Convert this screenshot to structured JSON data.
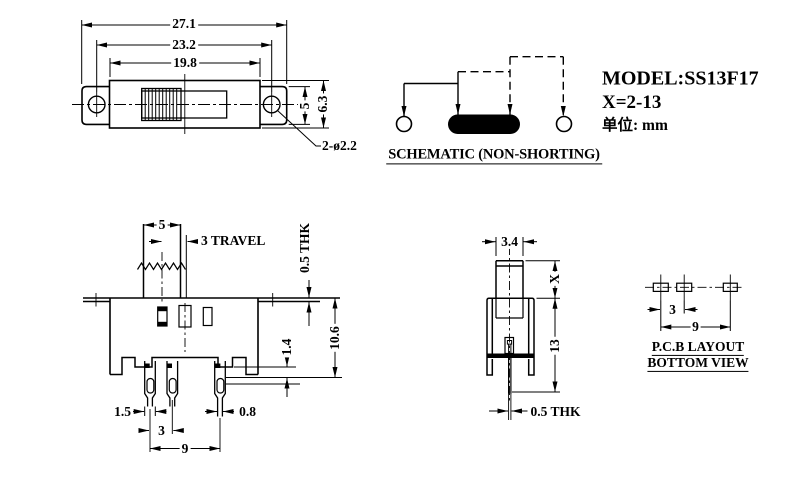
{
  "colors": {
    "ink": "#000000",
    "paper": "#ffffff"
  },
  "title_block": {
    "model": "MODEL:SS13F17",
    "x_range": "X=2-13",
    "unit_label": "单位: mm"
  },
  "schematic": {
    "caption": "SCHEMATIC (NON-SHORTING)"
  },
  "top_view": {
    "dim_overall": "27.1",
    "dim_hole_spacing": "23.2",
    "dim_body_length": "19.8",
    "dim_ear_height": "5",
    "dim_body_width": "6.3",
    "dim_holes": "2-ø2.2"
  },
  "front_view": {
    "dim_knob_width": "5",
    "dim_travel": "3 TRAVEL",
    "dim_flange_thk": "0.5 THK",
    "dim_body_height": "10.6",
    "dim_base_step": "1.4",
    "dim_pin_width": "1.5",
    "dim_pin_tail_width": "0.8",
    "dim_pin_pitch": "3",
    "dim_pin_span": "9"
  },
  "side_view": {
    "dim_knob_depth": "3.4",
    "dim_knob_height": "X",
    "dim_total_height": "13",
    "dim_pin_thk": "0.5 THK"
  },
  "pcb_layout": {
    "caption_line1": "P.C.B LAYOUT",
    "caption_line2": "BOTTOM VIEW",
    "dim_pad_pitch": "3",
    "dim_pad_span": "9"
  }
}
